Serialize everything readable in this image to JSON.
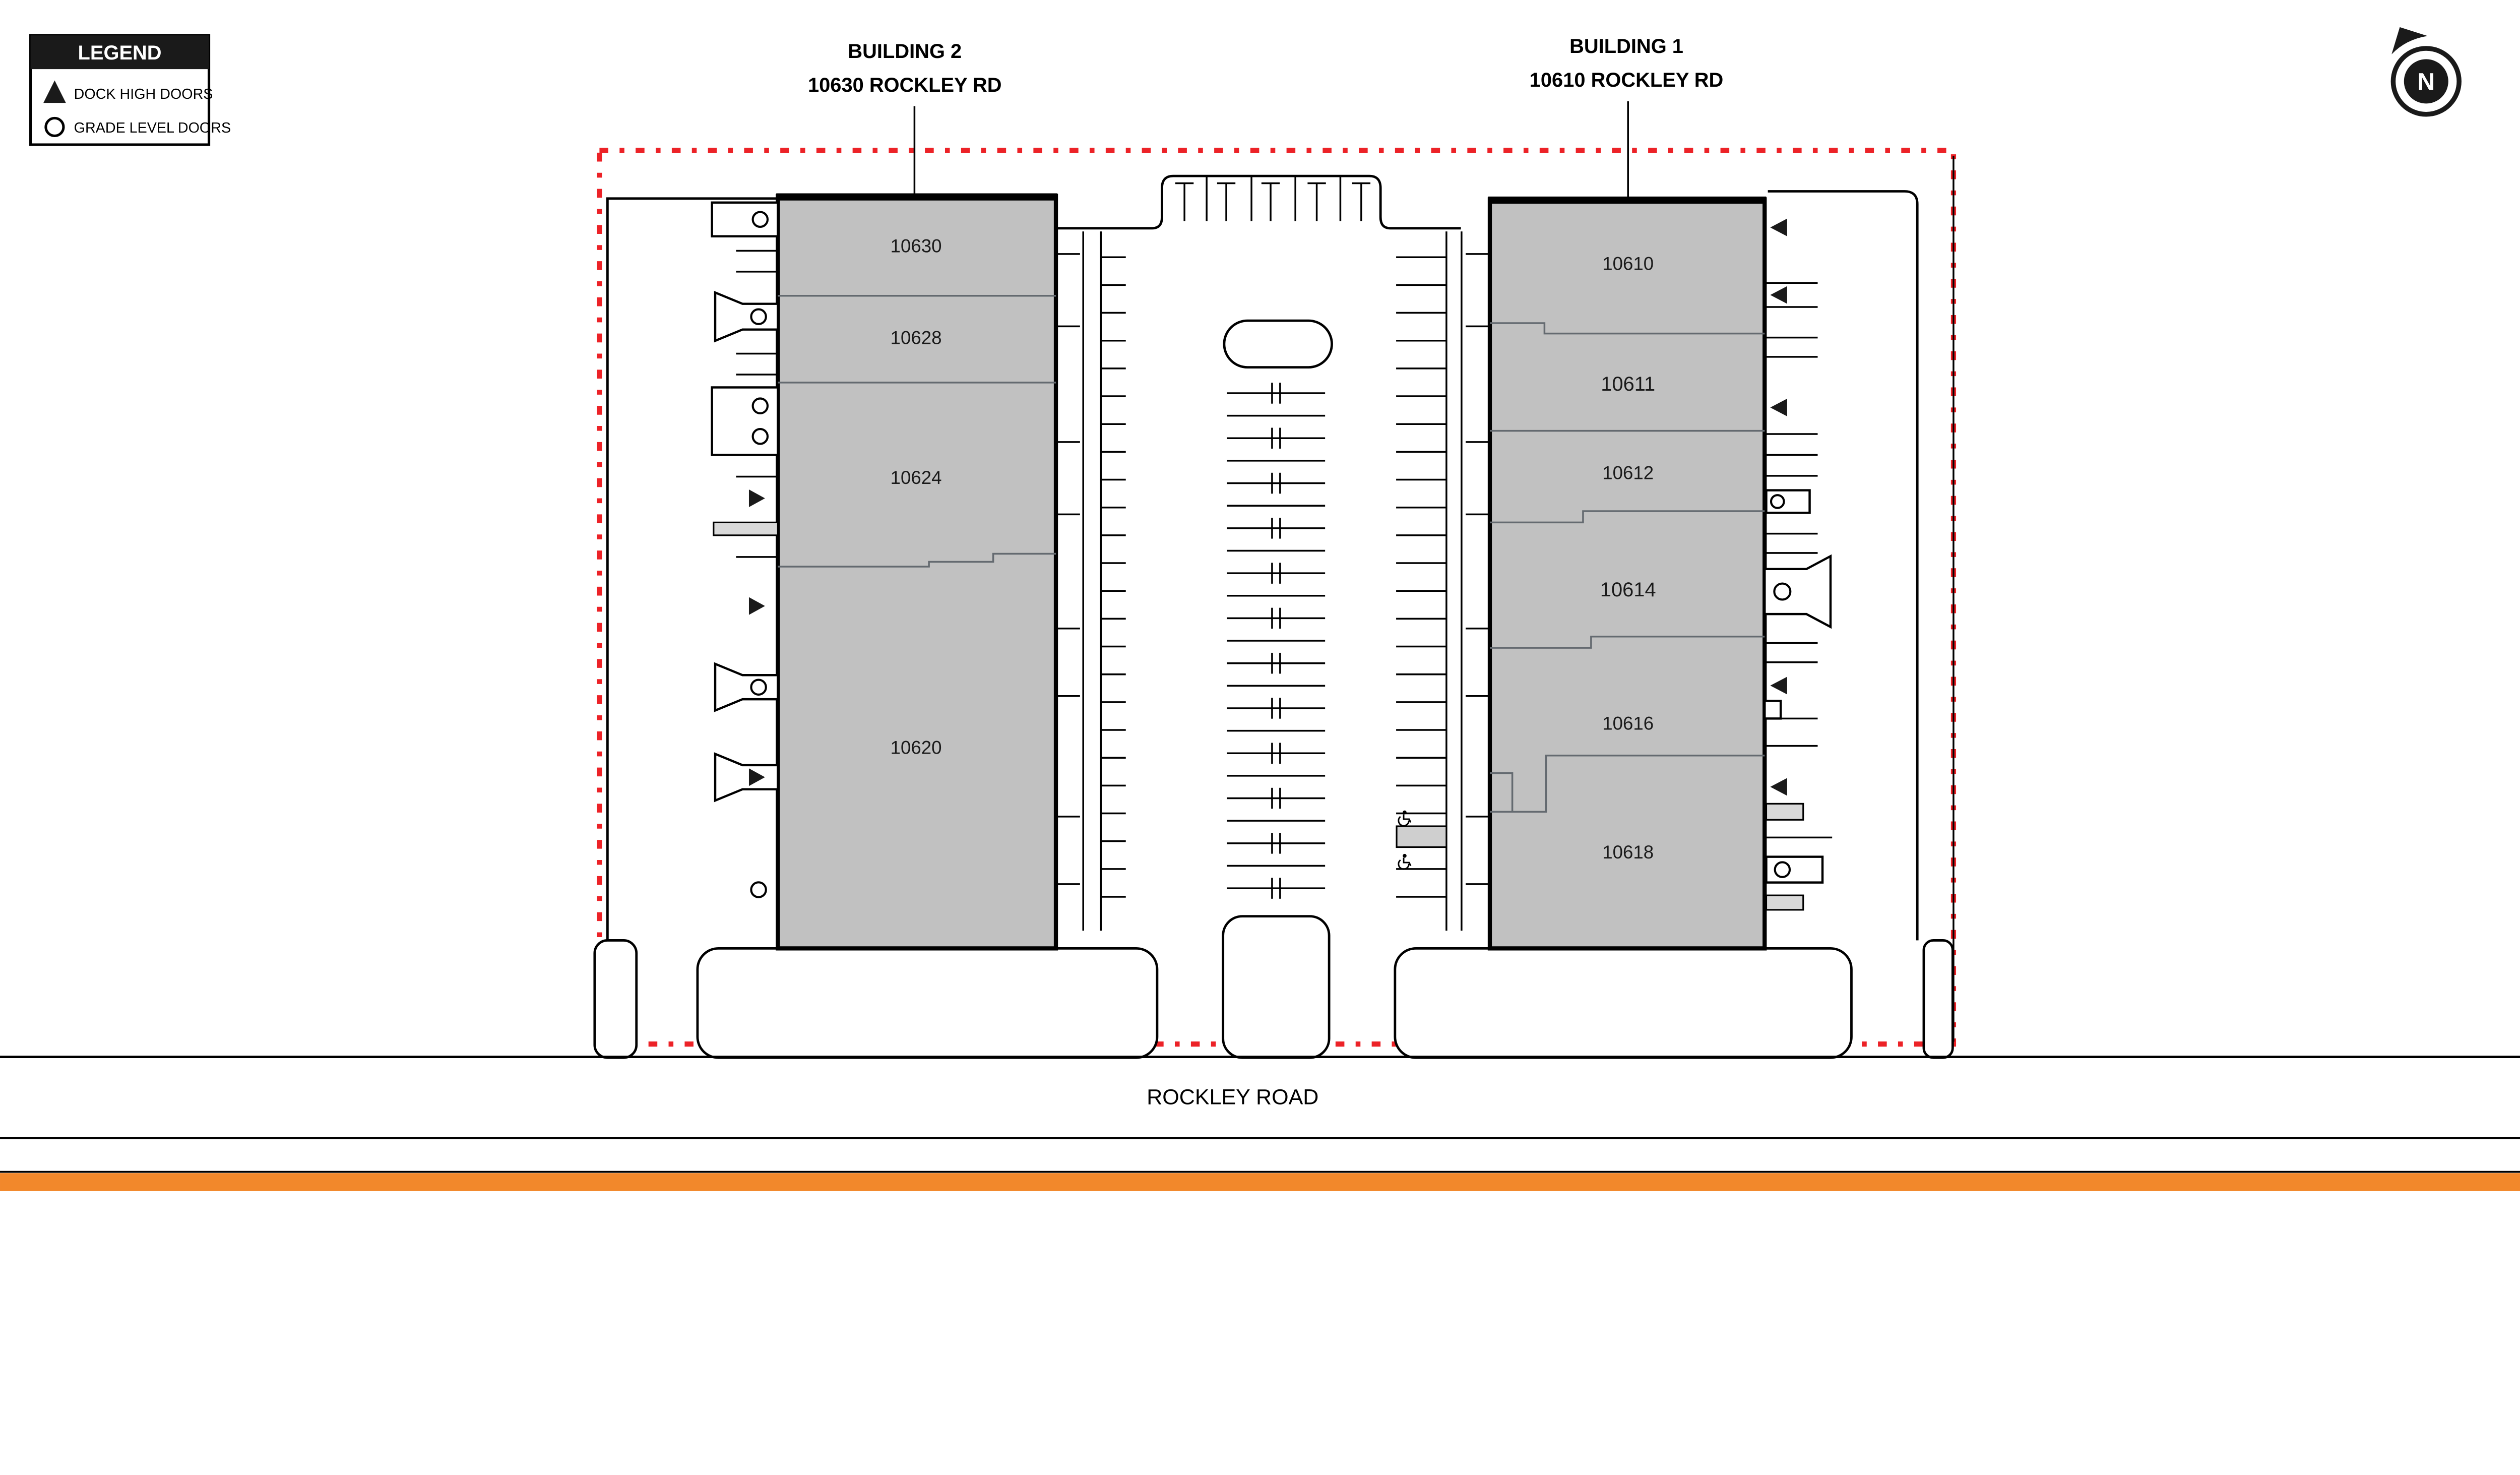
{
  "legend": {
    "title": "LEGEND",
    "items": [
      {
        "icon": "dock-high-triangle-icon",
        "label": "DOCK HIGH DOORS"
      },
      {
        "icon": "grade-level-circle-icon",
        "label": "GRADE LEVEL DOORS"
      }
    ]
  },
  "north": {
    "label": "N"
  },
  "buildings": {
    "building2": {
      "title": "BUILDING 2",
      "address": "10630 ROCKLEY RD",
      "units": [
        {
          "number": "10630"
        },
        {
          "number": "10628"
        },
        {
          "number": "10624"
        },
        {
          "number": "10620"
        }
      ]
    },
    "building1": {
      "title": "BUILDING 1",
      "address": "10610 ROCKLEY RD",
      "units": [
        {
          "number": "10610"
        },
        {
          "number": "10611"
        },
        {
          "number": "10612"
        },
        {
          "number": "10614"
        },
        {
          "number": "10616"
        },
        {
          "number": "10618"
        }
      ]
    }
  },
  "road": {
    "name": "ROCKLEY ROAD"
  },
  "colors": {
    "building_fill": "#C1C1C1",
    "property_line": "#EC2227",
    "accent_bar": "#F2882B",
    "ramp_fill": "#D9D9D9"
  }
}
